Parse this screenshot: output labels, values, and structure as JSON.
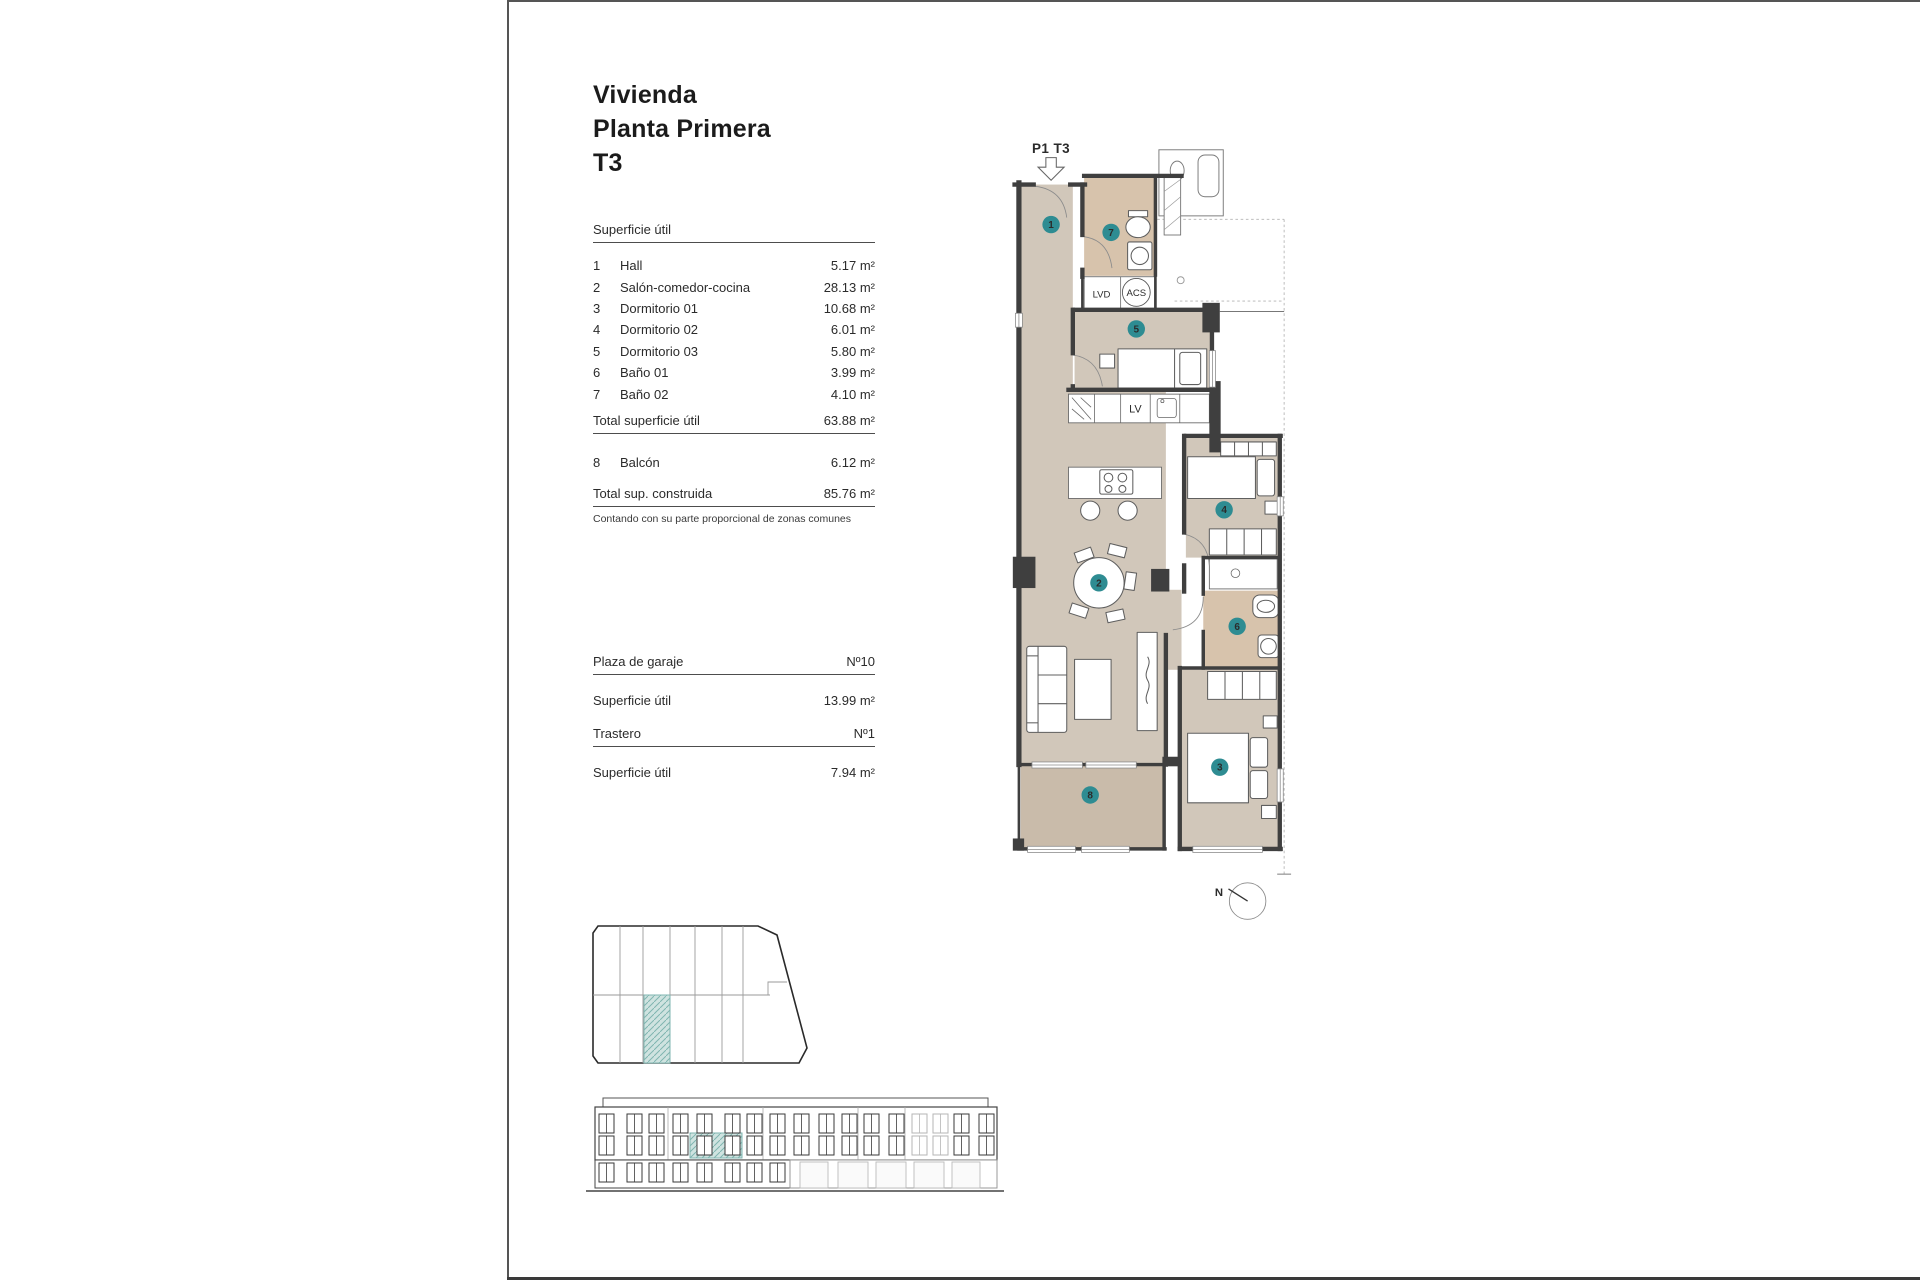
{
  "title": {
    "lines": [
      "Vivienda",
      "Planta Primera",
      "T3"
    ]
  },
  "surface": {
    "header": "Superficie útil",
    "rows": [
      {
        "num": "1",
        "label": "Hall",
        "value": "5.17 m²"
      },
      {
        "num": "2",
        "label": "Salón-comedor-cocina",
        "value": "28.13 m²"
      },
      {
        "num": "3",
        "label": "Dormitorio 01",
        "value": "10.68 m²"
      },
      {
        "num": "4",
        "label": "Dormitorio 02",
        "value": "6.01 m²"
      },
      {
        "num": "5",
        "label": "Dormitorio 03",
        "value": "5.80 m²"
      },
      {
        "num": "6",
        "label": "Baño 01",
        "value": "3.99 m²"
      },
      {
        "num": "7",
        "label": "Baño 02",
        "value": "4.10 m²"
      }
    ],
    "total_util": {
      "label": "Total superficie útil",
      "value": "63.88 m²"
    },
    "balcony": {
      "num": "8",
      "label": "Balcón",
      "value": "6.12 m²"
    },
    "total_built": {
      "label": "Total sup. construida",
      "value": "85.76 m²"
    },
    "footnote": "Contando con su parte proporcional de zonas comunes"
  },
  "garage": {
    "label": "Plaza de garaje",
    "number": "Nº10",
    "area_label": "Superficie útil",
    "area_value": "13.99 m²"
  },
  "storage": {
    "label": "Trastero",
    "number": "Nº1",
    "area_label": "Superficie útil",
    "area_value": "7.94 m²"
  },
  "floorplan": {
    "unit_label": "P1 T3",
    "labels": {
      "washer": "LVD",
      "heater": "ACS",
      "dishwasher": "LV"
    },
    "rooms": [
      {
        "n": "1"
      },
      {
        "n": "2"
      },
      {
        "n": "3"
      },
      {
        "n": "4"
      },
      {
        "n": "5"
      },
      {
        "n": "6"
      },
      {
        "n": "7"
      },
      {
        "n": "8"
      }
    ],
    "compass": {
      "label": "N"
    }
  },
  "colors": {
    "marker": "#2e8c92",
    "highlight_fill": "#cfe3e0",
    "highlight_stroke": "#7fb5b0",
    "wall": "#3f3f3f",
    "floor": "#d1c7ba",
    "floor_bath": "#d7c3ac",
    "floor_balcony": "#c9bbaa"
  }
}
